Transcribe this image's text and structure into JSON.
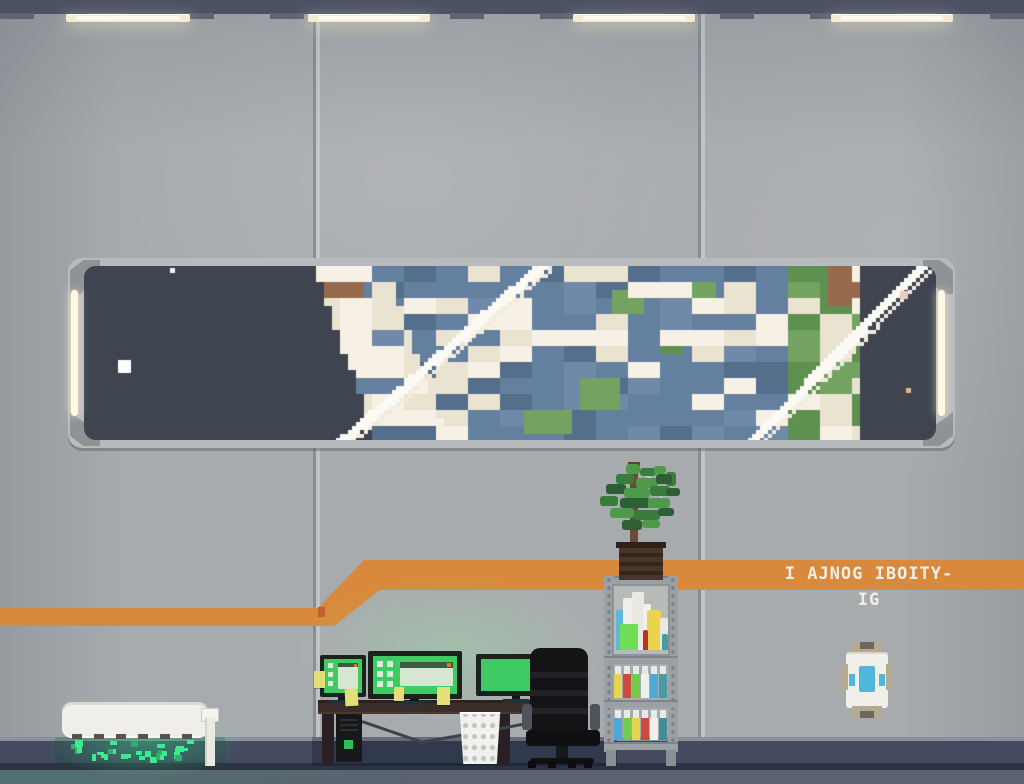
{
  "scene_title": "space station crew quarters with observation window",
  "signage": {
    "text": "I AJNOG IBOITY-IG"
  },
  "palette": {
    "wall": "#a8abae",
    "ceiling": "#4b5263",
    "lightbar": "#f3ecd2",
    "orange": "#d8893b",
    "orange_dark": "#c3602f",
    "frame": "#b8bbbd",
    "frame_bevel": "#8f9396",
    "space": "#3e4450",
    "ocean": "#64809f",
    "ocean_dark": "#546f8c",
    "ocean_light": "#6f8aa8",
    "cloud": "#ebe3d1",
    "cloud_bright": "#f6f1e4",
    "land": "#74a361",
    "land_dark": "#5e9150",
    "soil": "#976a4d",
    "soil_dark": "#7a5340",
    "skirt": "#424b60",
    "floor": "#5b6270",
    "desk": "#3b2d29",
    "bezel": "#1b211d",
    "screen": "#3ecb63",
    "orange_dot": "#d87730",
    "sticky": "#e4de77",
    "btn": "#2fbf57",
    "chair": "#141417",
    "shelf": "#9aa0a3",
    "machine": "#efeee8",
    "blue": "#4db7dc",
    "glow_green_a": "#3fe98d",
    "glow_green_b": "#2fae6d"
  },
  "ceiling_lights": [
    {
      "x": 66,
      "w": 124
    },
    {
      "x": 308,
      "w": 122
    },
    {
      "x": 573,
      "w": 122
    },
    {
      "x": 831,
      "w": 122
    }
  ],
  "window_scene": {
    "seed": 1337,
    "cell": 8,
    "left_edge": 28.5,
    "left_slope": 0.35,
    "right_edge": 96,
    "stars": [
      {
        "x": 34,
        "y": 94,
        "s": 13,
        "c": "#ffffff"
      },
      {
        "x": 86,
        "y": 2,
        "s": 5,
        "c": "#f4f4f0"
      },
      {
        "x": 816,
        "y": 25,
        "s": 8,
        "c": "#edc9c6"
      },
      {
        "x": 822,
        "y": 122,
        "s": 5,
        "c": "#e2b58b"
      }
    ],
    "islands": [
      {
        "c": 62,
        "r": 14,
        "w": 5,
        "h": 4,
        "color": "land"
      },
      {
        "c": 66,
        "r": 3,
        "w": 4,
        "h": 3,
        "color": "land"
      },
      {
        "c": 72,
        "r": 9,
        "w": 3,
        "h": 2,
        "color": "land_dark"
      },
      {
        "c": 55,
        "r": 18,
        "w": 6,
        "h": 3,
        "color": "land"
      },
      {
        "c": 76,
        "r": 2,
        "w": 3,
        "h": 2,
        "color": "land"
      }
    ],
    "streaks": [
      {
        "x0": 456,
        "y0": -6,
        "x1": 246,
        "y1": 180,
        "w": 8
      },
      {
        "x0": 836,
        "y0": -6,
        "x1": 656,
        "y1": 180,
        "w": 8
      }
    ]
  },
  "monitors": {
    "left": {
      "note": "window with titlebar and orange dot, 3 icons"
    },
    "middle": {
      "note": "wide panel with titlebar and orange dot, 6 icons"
    },
    "right": {
      "note": "blank green screen, single white pixel"
    }
  },
  "sticky_notes": [
    {
      "x": 314,
      "y": 671,
      "w": 11,
      "h": 17,
      "r": 0
    },
    {
      "x": 345,
      "y": 689,
      "w": 13,
      "h": 17,
      "r": -3
    },
    {
      "x": 394,
      "y": 687,
      "w": 10,
      "h": 14,
      "r": 2
    },
    {
      "x": 437,
      "y": 687,
      "w": 13,
      "h": 18,
      "r": 0
    },
    {
      "x": 549,
      "y": 655,
      "w": 12,
      "h": 14,
      "r": 0
    },
    {
      "x": 549,
      "y": 671,
      "w": 12,
      "h": 13,
      "r": 2
    }
  ],
  "cabinet_flasks": [
    {
      "x": 4,
      "y": 26,
      "w": 8,
      "h": 40,
      "c": "#5fb7d9"
    },
    {
      "x": 11,
      "y": 14,
      "w": 10,
      "h": 52,
      "c": "#efeee8"
    },
    {
      "x": 20,
      "y": 8,
      "w": 12,
      "h": 58,
      "c": "#e9e8e2"
    },
    {
      "x": 8,
      "y": 40,
      "w": 18,
      "h": 26,
      "c": "#6ede52"
    },
    {
      "x": 31,
      "y": 20,
      "w": 8,
      "h": 46,
      "c": "#f2f1eb"
    },
    {
      "x": 35,
      "y": 26,
      "w": 14,
      "h": 40,
      "c": "#ecd34c"
    },
    {
      "x": 31,
      "y": 46,
      "w": 5,
      "h": 20,
      "c": "#b8332c"
    },
    {
      "x": 48,
      "y": 34,
      "w": 8,
      "h": 32,
      "c": "#e9e8e2"
    },
    {
      "x": 50,
      "y": 50,
      "w": 6,
      "h": 16,
      "c": "#4a9ba0"
    }
  ],
  "bottle_rows": [
    {
      "y": 88,
      "h": 36,
      "colors": [
        "#e6d44e",
        "#cd4b3c",
        "#71cc4b",
        "#efefec",
        "#4fa8d8",
        "#4a9ba0"
      ]
    },
    {
      "y": 132,
      "h": 34,
      "colors": [
        "#4fa8d8",
        "#71cc4b",
        "#e6d44e",
        "#cd4b3c",
        "#efefec",
        "#3f8f94"
      ]
    }
  ],
  "leaf_blocks": [
    [
      30,
      6,
      14,
      10,
      0
    ],
    [
      44,
      10,
      16,
      8,
      1
    ],
    [
      58,
      8,
      12,
      8,
      0
    ],
    [
      70,
      14,
      10,
      14,
      1
    ],
    [
      20,
      16,
      18,
      10,
      1
    ],
    [
      40,
      20,
      22,
      10,
      0
    ],
    [
      60,
      16,
      16,
      10,
      2
    ],
    [
      10,
      26,
      20,
      10,
      2
    ],
    [
      28,
      30,
      26,
      10,
      0
    ],
    [
      54,
      28,
      20,
      10,
      1
    ],
    [
      70,
      30,
      14,
      8,
      2
    ],
    [
      4,
      38,
      18,
      10,
      1
    ],
    [
      24,
      40,
      30,
      10,
      2
    ],
    [
      52,
      40,
      22,
      10,
      0
    ],
    [
      14,
      50,
      24,
      10,
      0
    ],
    [
      38,
      52,
      26,
      10,
      1
    ],
    [
      62,
      50,
      16,
      8,
      2
    ],
    [
      26,
      62,
      20,
      10,
      2
    ],
    [
      46,
      62,
      18,
      8,
      0
    ]
  ],
  "leaf_greens": [
    "#4f9a4a",
    "#3a7b3e",
    "#2c5f33"
  ],
  "grow_lights": {
    "seed": 9,
    "count": 30
  }
}
